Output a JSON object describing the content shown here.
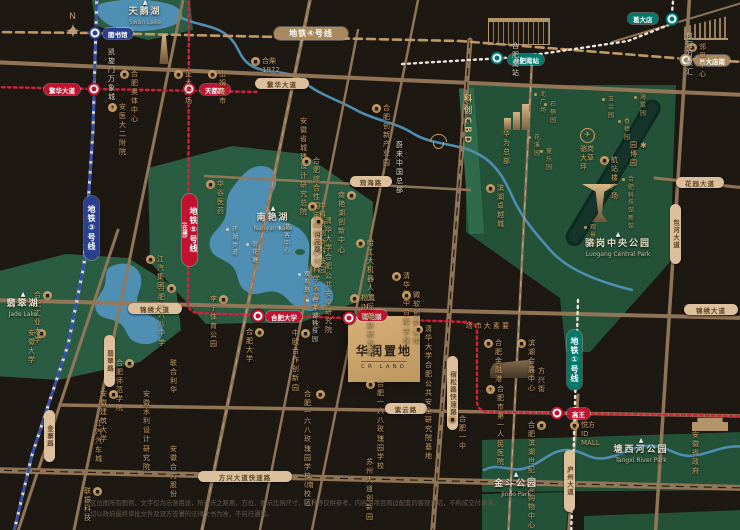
{
  "map": {
    "compass": "N",
    "kechuang": "科创CBD",
    "crland": {
      "name": "华润置地",
      "latin": "CR LAND"
    },
    "colors": {
      "line1": "#00796d",
      "line3": "#2b3f90",
      "line4": "#a98a5e",
      "line5": "#c2122f",
      "road": "#97795a",
      "park": "#27583f",
      "water": "#4f8fb4",
      "gold": "#c9a063",
      "bg": "#1e1813"
    },
    "metroBadges": [
      {
        "x": 274,
        "y": 27,
        "w": 74,
        "h": 13,
        "label": "地铁④号线",
        "color": "#a98a5e"
      },
      {
        "x": 84,
        "y": 196,
        "w": 15,
        "h": 64,
        "label": "地铁③号线",
        "color": "#2b3f90",
        "cls": "vert"
      },
      {
        "x": 182,
        "y": 194,
        "w": 15,
        "h": 72,
        "label": "地铁⑤号线",
        "sub": "(在建)",
        "color": "#c2122f",
        "cls": "vert"
      },
      {
        "x": 567,
        "y": 330,
        "w": 15,
        "h": 60,
        "label": "地铁①号线",
        "color": "#00796d",
        "cls": "vert"
      }
    ],
    "stationBadges": [
      {
        "x": 103,
        "y": 28,
        "label": "图书馆",
        "color": "#2b3f90"
      },
      {
        "x": 44,
        "y": 84,
        "label": "繁华大道",
        "color": "#c2122f"
      },
      {
        "x": 200,
        "y": 84,
        "label": "天都路",
        "color": "#c2122f"
      },
      {
        "x": 508,
        "y": 54,
        "label": "合肥南站",
        "color": "#00796d"
      },
      {
        "x": 628,
        "y": 13,
        "label": "葛大店",
        "color": "#00796d"
      },
      {
        "x": 694,
        "y": 55,
        "label": "葛大店南",
        "color": "#a98a5e"
      },
      {
        "x": 266,
        "y": 311,
        "label": "合肥大学",
        "color": "#c2122f"
      },
      {
        "x": 357,
        "y": 310,
        "label": "南艳湖",
        "color": "#c2122f"
      },
      {
        "x": 567,
        "y": 408,
        "label": "高王",
        "color": "#c2122f"
      }
    ],
    "stations": [
      {
        "x": 95,
        "y": 33,
        "ring": "#2b3f90"
      },
      {
        "x": 94,
        "y": 89,
        "ring": "#c2122f"
      },
      {
        "x": 189,
        "y": 89,
        "ring": "#c2122f"
      },
      {
        "x": 497,
        "y": 58,
        "ring": "#00796d"
      },
      {
        "x": 672,
        "y": 19,
        "ring": "#00796d"
      },
      {
        "x": 686,
        "y": 60,
        "ring": "#a98a5e"
      },
      {
        "x": 258,
        "y": 316,
        "ring": "#c2122f"
      },
      {
        "x": 349,
        "y": 318,
        "ring": "#c2122f"
      },
      {
        "x": 557,
        "y": 413,
        "ring": "#c2122f"
      }
    ],
    "roadLabels": [
      {
        "x": 255,
        "y": 78,
        "w": 54,
        "label": "繁华大道"
      },
      {
        "x": 350,
        "y": 176,
        "w": 42,
        "label": "观海路"
      },
      {
        "x": 128,
        "y": 303,
        "w": 54,
        "label": "锦绣大道"
      },
      {
        "x": 684,
        "y": 304,
        "w": 54,
        "label": "锦绣大道"
      },
      {
        "x": 385,
        "y": 403,
        "w": 42,
        "label": "紫云路"
      },
      {
        "x": 198,
        "y": 471,
        "w": 94,
        "label": "方兴大道快速路"
      },
      {
        "x": 676,
        "y": 177,
        "w": 48,
        "label": "花园大道"
      },
      {
        "x": 311,
        "y": 216,
        "h": 42,
        "label": "习友路",
        "cls": "v"
      },
      {
        "x": 104,
        "y": 335,
        "h": 42,
        "label": "翡翠路",
        "cls": "v"
      },
      {
        "x": 44,
        "y": 410,
        "h": 42,
        "label": "金寨路",
        "cls": "v"
      },
      {
        "x": 447,
        "y": 356,
        "h": 64,
        "label": "宿松路快速路",
        "cls": "v"
      },
      {
        "x": 670,
        "y": 204,
        "h": 50,
        "label": "包河大道",
        "cls": "v"
      },
      {
        "x": 564,
        "y": 450,
        "h": 52,
        "label": "庐州大道",
        "cls": "v"
      }
    ],
    "parkNames": [
      {
        "x": 110,
        "y": 0,
        "label": "天鹅湖",
        "en": "Swan Lake",
        "icon": "landmark"
      },
      {
        "x": 238,
        "y": 206,
        "label": "南艳湖",
        "en": "Nanyan Lake",
        "icon": "landmark"
      },
      {
        "x": -12,
        "y": 292,
        "label": "翡翠湖",
        "en": "Jade Lake",
        "icon": "landmark"
      },
      {
        "x": 583,
        "y": 232,
        "label": "骆岗中央公园",
        "en": "Luogang Central Park",
        "icon": "landmark"
      },
      {
        "x": 606,
        "y": 438,
        "label": "塘西河公园",
        "en": "Tangxi River Park",
        "icon": "landmark"
      },
      {
        "x": 481,
        "y": 472,
        "label": "金斗公园",
        "en": "Jindo Park",
        "icon": "landmark"
      }
    ],
    "pois": [
      {
        "x": 108,
        "y": 48,
        "label": "凯旋门 万象城",
        "cls": "w"
      },
      {
        "x": 120,
        "y": 70,
        "label": "合肥奥体中心",
        "icon": "building"
      },
      {
        "x": 174,
        "y": 70,
        "label": "正大广场",
        "icon": "building"
      },
      {
        "x": 208,
        "y": 70,
        "label": "山姆超市",
        "icon": "building"
      },
      {
        "x": 108,
        "y": 103,
        "label": "安医大二附院",
        "icon": "hospital"
      },
      {
        "x": 251,
        "y": 57,
        "label": "合柴1972",
        "icon": "building"
      },
      {
        "x": 300,
        "y": 117,
        "label": "安徽省城建\n设计研究总院"
      },
      {
        "x": 302,
        "y": 157,
        "label": "合肥综合性\n国家科学中心大科学装置集中区",
        "icon": "building"
      },
      {
        "x": 372,
        "y": 104,
        "label": "合肥创新产业园",
        "icon": "building"
      },
      {
        "x": 396,
        "y": 141,
        "label": "蔚来中国总部",
        "cls": "w"
      },
      {
        "x": 338,
        "y": 191,
        "label": "南艳湖创新中心",
        "icon": "building",
        "side": "r"
      },
      {
        "x": 308,
        "y": 202,
        "label": "中科院创新科技园",
        "icon": "building"
      },
      {
        "x": 314,
        "y": 217,
        "label": "清华大学\n合肥公共安全研究院",
        "icon": "building"
      },
      {
        "x": 356,
        "y": 239,
        "label": "哈工大\n机器人国际创新研究院",
        "icon": "building"
      },
      {
        "x": 392,
        "y": 272,
        "label": "清华附中\n合肥学校",
        "icon": "building"
      },
      {
        "x": 158,
        "y": 284,
        "label": "合肥一六八中学",
        "icon": "building",
        "side": "r"
      },
      {
        "x": 210,
        "y": 295,
        "label": "李宁体育公园",
        "icon": "building",
        "side": "r"
      },
      {
        "x": 350,
        "y": 294,
        "label": "松岚IN PARK!",
        "icon": "building"
      },
      {
        "x": 402,
        "y": 291,
        "label": "微软创新基地",
        "icon": "building"
      },
      {
        "x": 246,
        "y": 328,
        "label": "合肥大学",
        "icon": "building",
        "side": "r"
      },
      {
        "x": 292,
        "y": 329,
        "label": "中欧合作创新园",
        "icon": "building",
        "side": "r"
      },
      {
        "x": 414,
        "y": 325,
        "label": "清华大学\n合肥公共安全\n研究院基地",
        "icon": "building"
      },
      {
        "x": 366,
        "y": 380,
        "label": "合肥一六八玫瑰园学校",
        "icon": "building"
      },
      {
        "x": 304,
        "y": 390,
        "label": "合肥一六八玫瑰园学校\n(南校区)",
        "icon": "building",
        "side": "r"
      },
      {
        "x": 464,
        "y": 322,
        "label": "要素大市场",
        "cls": "vert"
      },
      {
        "x": 484,
        "y": 339,
        "label": "合肥金融港",
        "icon": "building"
      },
      {
        "x": 517,
        "y": 339,
        "label": "滨湖会展中心",
        "icon": "building"
      },
      {
        "x": 538,
        "y": 367,
        "label": "方兴街"
      },
      {
        "x": 486,
        "y": 385,
        "label": "合肥市\n第一人民医院",
        "icon": "hospital"
      },
      {
        "x": 448,
        "y": 415,
        "label": "合肥\n一中",
        "icon": "building"
      },
      {
        "x": 528,
        "y": 421,
        "label": "合肥滨湖\n世纪金源购物中心",
        "icon": "building",
        "side": "r"
      },
      {
        "x": 570,
        "y": 421,
        "label": "悦方ID MALL",
        "icon": "building"
      },
      {
        "x": 692,
        "y": 431,
        "label": "安徽省政府"
      },
      {
        "x": 688,
        "y": 43,
        "label": "邻里中心",
        "icon": "building"
      },
      {
        "x": 686,
        "y": 32,
        "label": "包河万象汇",
        "cls": "w"
      },
      {
        "x": 503,
        "y": 130,
        "label": "华为总部"
      },
      {
        "x": 512,
        "y": 42,
        "label": "合肥南站",
        "cls": "w"
      },
      {
        "x": 146,
        "y": 255,
        "label": "江汽集团",
        "icon": "building"
      },
      {
        "x": 116,
        "y": 359,
        "label": "合肥师范学院",
        "icon": "building",
        "side": "r"
      },
      {
        "x": 170,
        "y": 359,
        "label": "联合利华"
      },
      {
        "x": 100,
        "y": 390,
        "label": "安徽建筑大学",
        "icon": "building",
        "side": "r"
      },
      {
        "x": 143,
        "y": 390,
        "label": "安徽水利设计研究院"
      },
      {
        "x": 170,
        "y": 445,
        "label": "安徽合力股份"
      },
      {
        "x": 95,
        "y": 419,
        "label": "江汽汽车城"
      },
      {
        "x": 366,
        "y": 458,
        "label": "苏州大道创新园"
      },
      {
        "x": 84,
        "y": 487,
        "label": "联振科技",
        "icon": "building",
        "side": "r"
      },
      {
        "x": 206,
        "y": 180,
        "label": "华谷医药",
        "icon": "building"
      },
      {
        "x": 226,
        "y": 226,
        "label": "环湖步道",
        "cls": "tinyw"
      },
      {
        "x": 278,
        "y": 224,
        "label": "游客中心",
        "cls": "tinyw"
      },
      {
        "x": 246,
        "y": 241,
        "label": "荷花塘",
        "cls": "tinyw"
      },
      {
        "x": 298,
        "y": 271,
        "label": "观鸟岛",
        "cls": "tinyw"
      },
      {
        "x": 306,
        "y": 297,
        "label": "梅冲湖科技园",
        "cls": "tinyw"
      },
      {
        "x": 534,
        "y": 91,
        "label": "北广场",
        "cls": "tiny"
      },
      {
        "x": 544,
        "y": 101,
        "label": "石楠园",
        "cls": "tiny"
      },
      {
        "x": 602,
        "y": 96,
        "label": "玉兰园",
        "cls": "tiny"
      },
      {
        "x": 634,
        "y": 94,
        "label": "海棠园",
        "cls": "tiny"
      },
      {
        "x": 618,
        "y": 118,
        "label": "香樟园",
        "cls": "tiny"
      },
      {
        "x": 528,
        "y": 134,
        "label": "花溪园",
        "cls": "tiny"
      },
      {
        "x": 540,
        "y": 148,
        "label": "童乐园",
        "cls": "tiny"
      },
      {
        "x": 580,
        "y": 128,
        "label": "骆岗大草坪",
        "icon": "plane",
        "cls": "col"
      },
      {
        "x": 630,
        "y": 141,
        "label": "园博园",
        "icon": "flower",
        "side": "r"
      },
      {
        "x": 600,
        "y": 156,
        "label": "航站楼广场",
        "icon": "building"
      },
      {
        "x": 622,
        "y": 176,
        "label": "合肥科技馆新馆",
        "cls": "tiny"
      },
      {
        "x": 584,
        "y": 224,
        "label": "观景塔",
        "cls": "tiny"
      },
      {
        "x": 486,
        "y": 184,
        "label": "滨湖卓越城",
        "icon": "building"
      },
      {
        "x": 28,
        "y": 329,
        "label": "安徽大学",
        "icon": "building",
        "side": "r"
      },
      {
        "x": 34,
        "y": 291,
        "label": "合肥工业大学",
        "icon": "building",
        "side": "r"
      }
    ],
    "disclaimer": {
      "line1": "本区位图所有图例、文字仅为示意用途，所表示之距离、方位、图示比例尺寸、边界等仅供参考，内容为项目周边配套的客观介绍，不构成交付承诺，",
      "line2": "一切以政府最终审批文件及双方签署的法律文书为准，不另行通知。"
    }
  }
}
